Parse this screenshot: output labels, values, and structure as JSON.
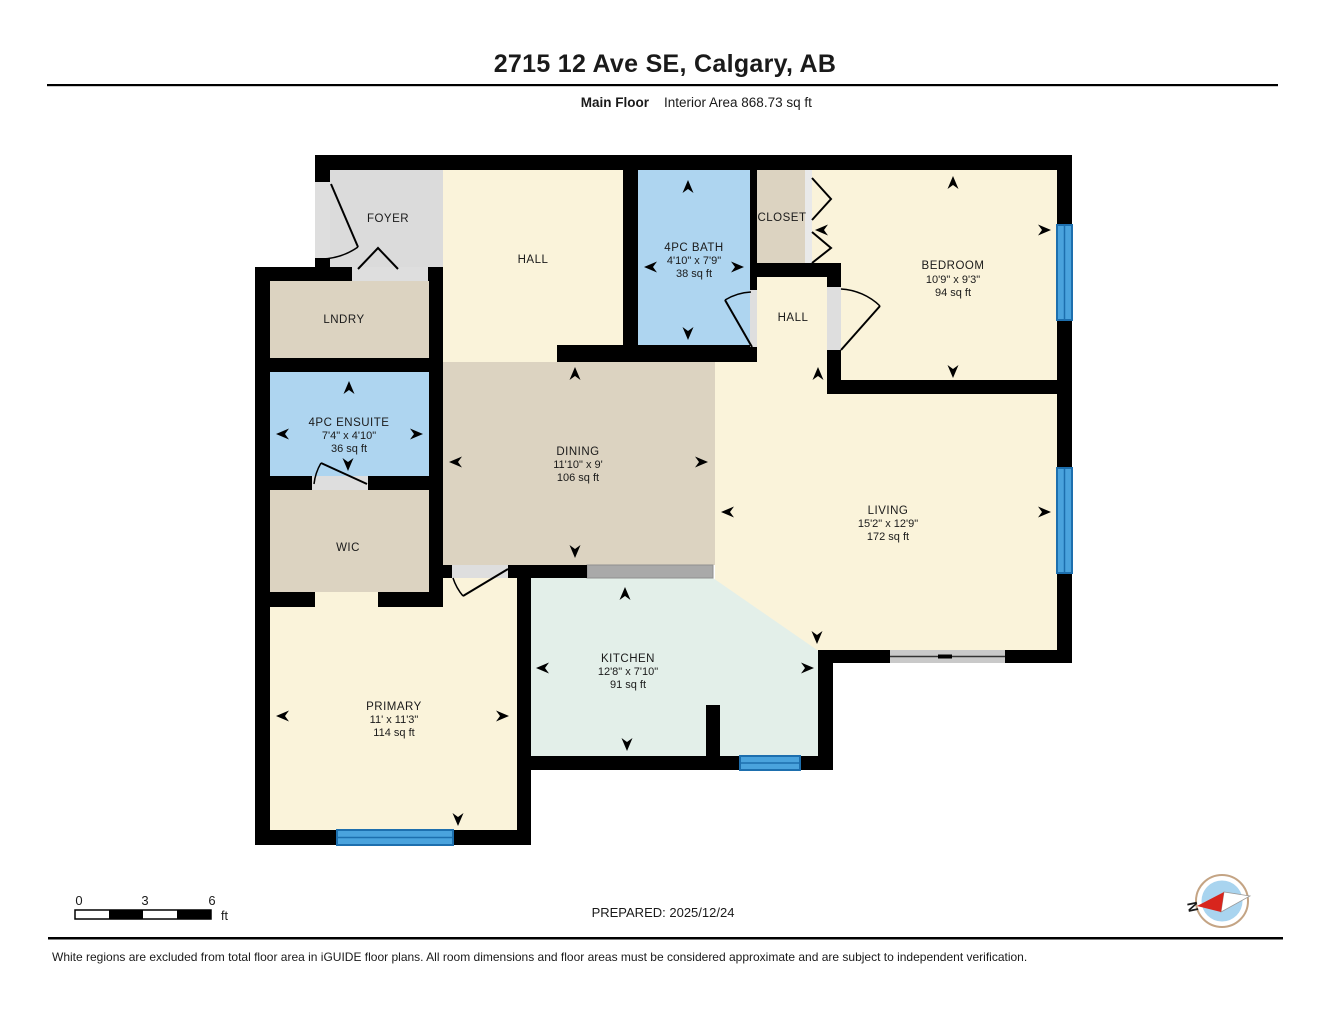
{
  "header": {
    "title": "2715 12 Ave SE, Calgary, AB",
    "floor_label": "Main Floor",
    "interior_area": "Interior Area 868.73 sq ft"
  },
  "rooms": {
    "foyer": {
      "name": "FOYER"
    },
    "hall_main": {
      "name": "HALL"
    },
    "bath": {
      "name": "4PC BATH",
      "dims": "4'10\" x 7'9\"",
      "area": "38 sq ft"
    },
    "closet": {
      "name": "CLOSET"
    },
    "bedroom": {
      "name": "BEDROOM",
      "dims": "10'9\" x 9'3\"",
      "area": "94 sq ft"
    },
    "hall_small": {
      "name": "HALL"
    },
    "lndry": {
      "name": "LNDRY"
    },
    "ensuite": {
      "name": "4PC ENSUITE",
      "dims": "7'4\" x 4'10\"",
      "area": "36 sq ft"
    },
    "wic": {
      "name": "WIC"
    },
    "dining": {
      "name": "DINING",
      "dims": "11'10\" x 9'",
      "area": "106 sq ft"
    },
    "living": {
      "name": "LIVING",
      "dims": "15'2\" x 12'9\"",
      "area": "172 sq ft"
    },
    "kitchen": {
      "name": "KITCHEN",
      "dims": "12'8\" x 7'10\"",
      "area": "91 sq ft"
    },
    "primary": {
      "name": "PRIMARY",
      "dims": "11' x 11'3\"",
      "area": "114 sq ft"
    }
  },
  "scale_bar": {
    "tick0": "0",
    "tick1": "3",
    "tick2": "6",
    "unit": "ft"
  },
  "footer": {
    "prepared": "PREPARED: 2025/12/24",
    "compass_label": "N",
    "disclaimer": "White regions are excluded from total floor area in iGUIDE floor plans. All room dimensions and floor areas must be considered approximate and are subject to independent verification."
  },
  "colors": {
    "wall": "#000000",
    "room_cream": "#faf3da",
    "room_tan": "#dcd3c1",
    "room_blue": "#aed5f0",
    "room_gray": "#dbdbdb",
    "room_mint": "#e3efe9",
    "door_gray": "#dedede",
    "window_fill": "#4aa3dd",
    "window_edge": "#1d6fae",
    "counter_gray": "#a9a9a9",
    "slider_gray": "#c9c9c9",
    "compass_blue": "#a9d4ef",
    "compass_red": "#d8251d",
    "compass_ring": "#c4a484",
    "text": "#1a1a1a"
  }
}
